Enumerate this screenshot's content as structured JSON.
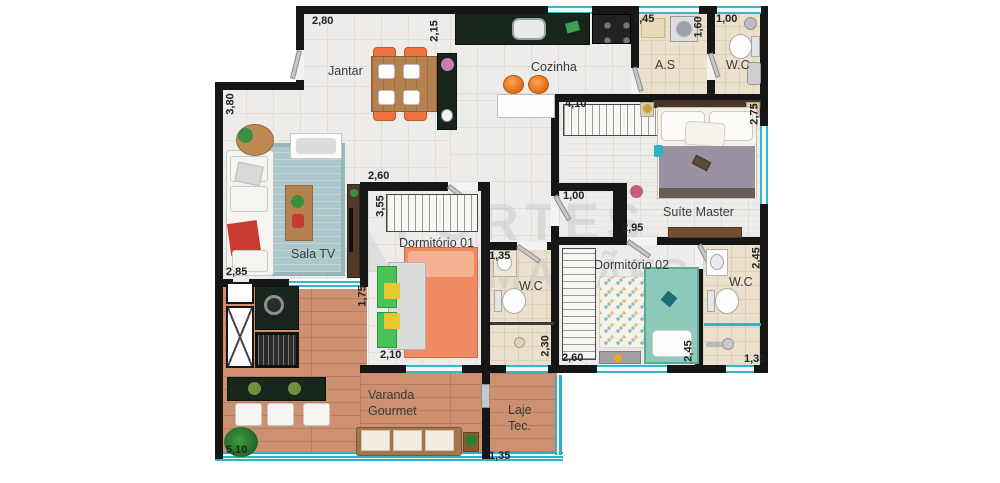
{
  "watermark": {
    "line1": "FORTES",
    "line2": "GUIMARÃES",
    "number_fragment": "080"
  },
  "rooms": {
    "jantar": "Jantar",
    "cozinha": "Cozinha",
    "area_servico": "A.S",
    "wc_top": "W.C",
    "sala_tv": "Sala TV",
    "dormitorio_01": "Dormitório 01",
    "suite_master": "Suíte Master",
    "dormitorio_02": "Dormitório 02",
    "wc_meio": "W.C",
    "wc_suite": "W.C",
    "varanda_line1": "Varanda",
    "varanda_line2": "Gourmet",
    "laje_line1": "Laje",
    "laje_line2": "Tec."
  },
  "dims": {
    "jantar_top": "2,80",
    "jantar_right": "2,15",
    "cozinha_top": "3,45",
    "as_top": "1,45",
    "as_right": "1,60",
    "wc_top_width": "1,00",
    "sala_left": "3,80",
    "sala_left_bottom": "2,85",
    "dorm1_top": "2,60",
    "dorm1_left": "3,55",
    "dorm1_bottom": "2,10",
    "dorm1_varanda": "1,75",
    "suite_top": "4,10",
    "suite_right": "2,75",
    "hall_width": "1,00",
    "suite_bottom": "2,95",
    "wc_meio_top": "1,35",
    "wc_meio_bottom": "2,30",
    "dorm2_bottom": "2,60",
    "dorm2_right": "2,45",
    "wc_suite_right": "2,45",
    "wc_suite_bottom": "1,35",
    "varanda_bottom": "5,10",
    "laje_bottom": "1,35"
  }
}
